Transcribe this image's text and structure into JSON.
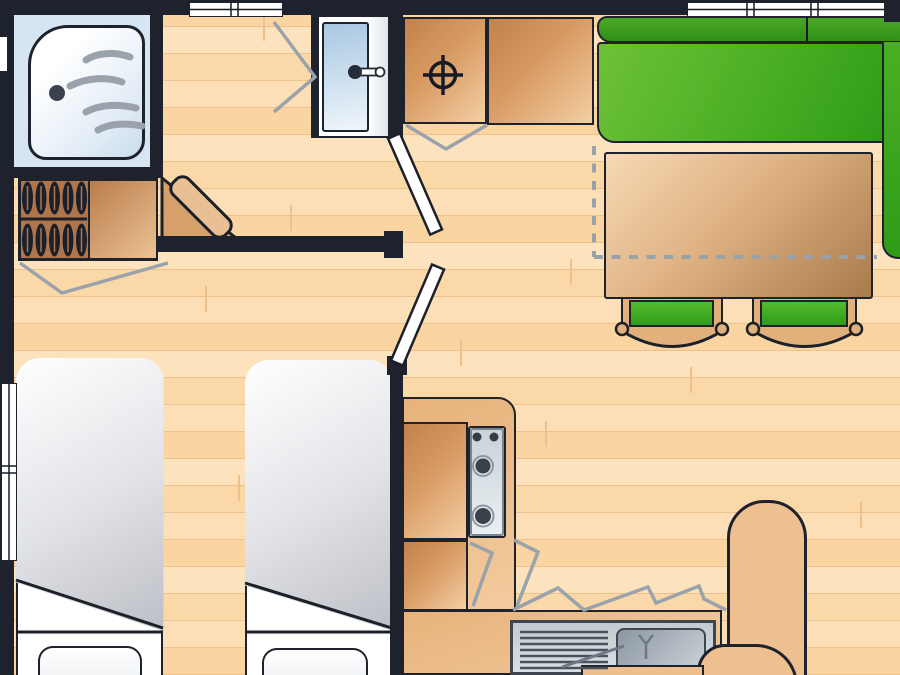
{
  "diagram": {
    "kind": "floor-plan",
    "view": "top-down",
    "text_labels": [],
    "rooms": [
      {
        "id": "shower-room",
        "name": "shower room with wardrobe"
      },
      {
        "id": "washroom",
        "name": "washbasin room"
      },
      {
        "id": "toilet-room",
        "name": "toilet compartment"
      },
      {
        "id": "bedroom",
        "name": "bedroom with two single beds"
      },
      {
        "id": "living-dining",
        "name": "living-dining area"
      },
      {
        "id": "kitchen",
        "name": "kitchen corner"
      }
    ],
    "furniture": [
      {
        "id": "shower-tray",
        "name": "shower tray with water waves and drain"
      },
      {
        "id": "wardrobe",
        "name": "wardrobe with two rows of hangers and shelf"
      },
      {
        "id": "corner-shelf",
        "name": "corner shelf unit"
      },
      {
        "id": "washbasin",
        "name": "washbasin with tap"
      },
      {
        "id": "toilet-marker",
        "name": "toilet position symbol (circle-cross)"
      },
      {
        "id": "storage-cabinets",
        "name": "two storage cabinets",
        "count": 2
      },
      {
        "id": "sofa",
        "name": "L-shaped green sofa"
      },
      {
        "id": "dining-table",
        "name": "rectangular dining table"
      },
      {
        "id": "stools",
        "name": "green-topped stools under table",
        "count": 2
      },
      {
        "id": "beds",
        "name": "single beds with duvets and pillows",
        "count": 2
      },
      {
        "id": "kitchen-counter",
        "name": "L-shaped kitchen counter"
      },
      {
        "id": "hob",
        "name": "hob with four burners"
      },
      {
        "id": "kitchen-sink",
        "name": "kitchen sink with drainer"
      },
      {
        "id": "chairs",
        "name": "rounded chairs near kitchen",
        "count": 2
      },
      {
        "id": "doors",
        "name": "open door leaves",
        "count": 2
      },
      {
        "id": "windows",
        "name": "windows in walls",
        "count": 3
      },
      {
        "id": "conversion-dashes",
        "name": "dashed conversion outline at dining area"
      }
    ],
    "colors": {
      "wall_black": "#1e222d",
      "floor_light": "#fde3bd",
      "floor_mid": "#fbd5a1",
      "sofa_green": "#4aaf24",
      "stool_green": "#3fae22",
      "table_wood": "#dfb283",
      "cabinet_wood": "#d89b64",
      "counter_tan": "#eebd8c",
      "chair_tan": "#eec08f",
      "wardrobe_brown": "#b0754a",
      "shower_blue": "#d6e5f2",
      "basin_blue": "#b9d3e8",
      "metal_gray": "#c9d2d8",
      "duvet_gray": "#b2b5bd",
      "swing_gray": "#9aa2ab",
      "dash_gray": "#9aa1a9",
      "door_white": "#ffffff",
      "stool_tan": "#e2b17b",
      "window_white": "#ffffff"
    }
  }
}
